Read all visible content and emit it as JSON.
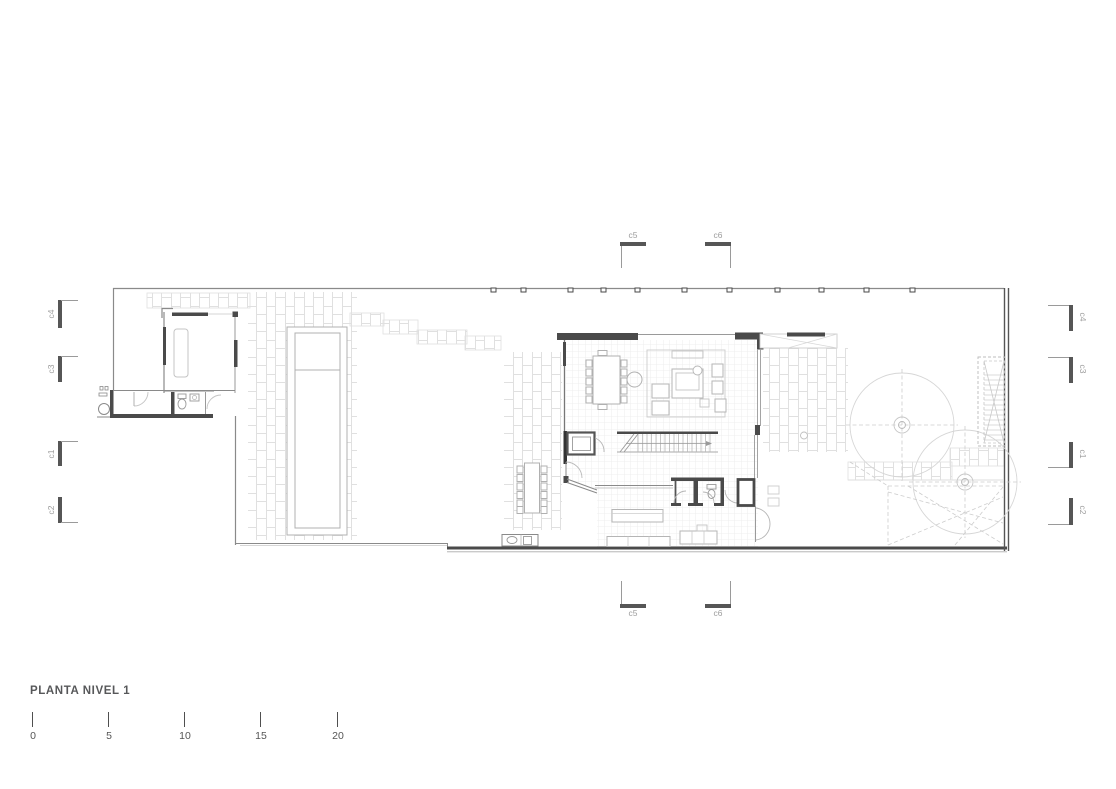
{
  "title": "PLANTA NIVEL 1",
  "scale_bar": {
    "labels": [
      "0",
      "5",
      "10",
      "15",
      "20"
    ]
  },
  "section_markers": {
    "top": [
      "c5",
      "c6"
    ],
    "bottom": [
      "c5",
      "c6"
    ],
    "left": [
      "c4",
      "c3",
      "c1",
      "c2"
    ],
    "right": [
      "c4",
      "c3",
      "c1",
      "c2"
    ]
  },
  "colors": {
    "wall": "#4a4a4a",
    "medium_line": "#8a8a8a",
    "furniture_line": "#b5b5b5",
    "paver_line": "#dfdfdf",
    "marker_text": "#9c9c9c",
    "title_text": "#57585a",
    "background": "#ffffff"
  }
}
